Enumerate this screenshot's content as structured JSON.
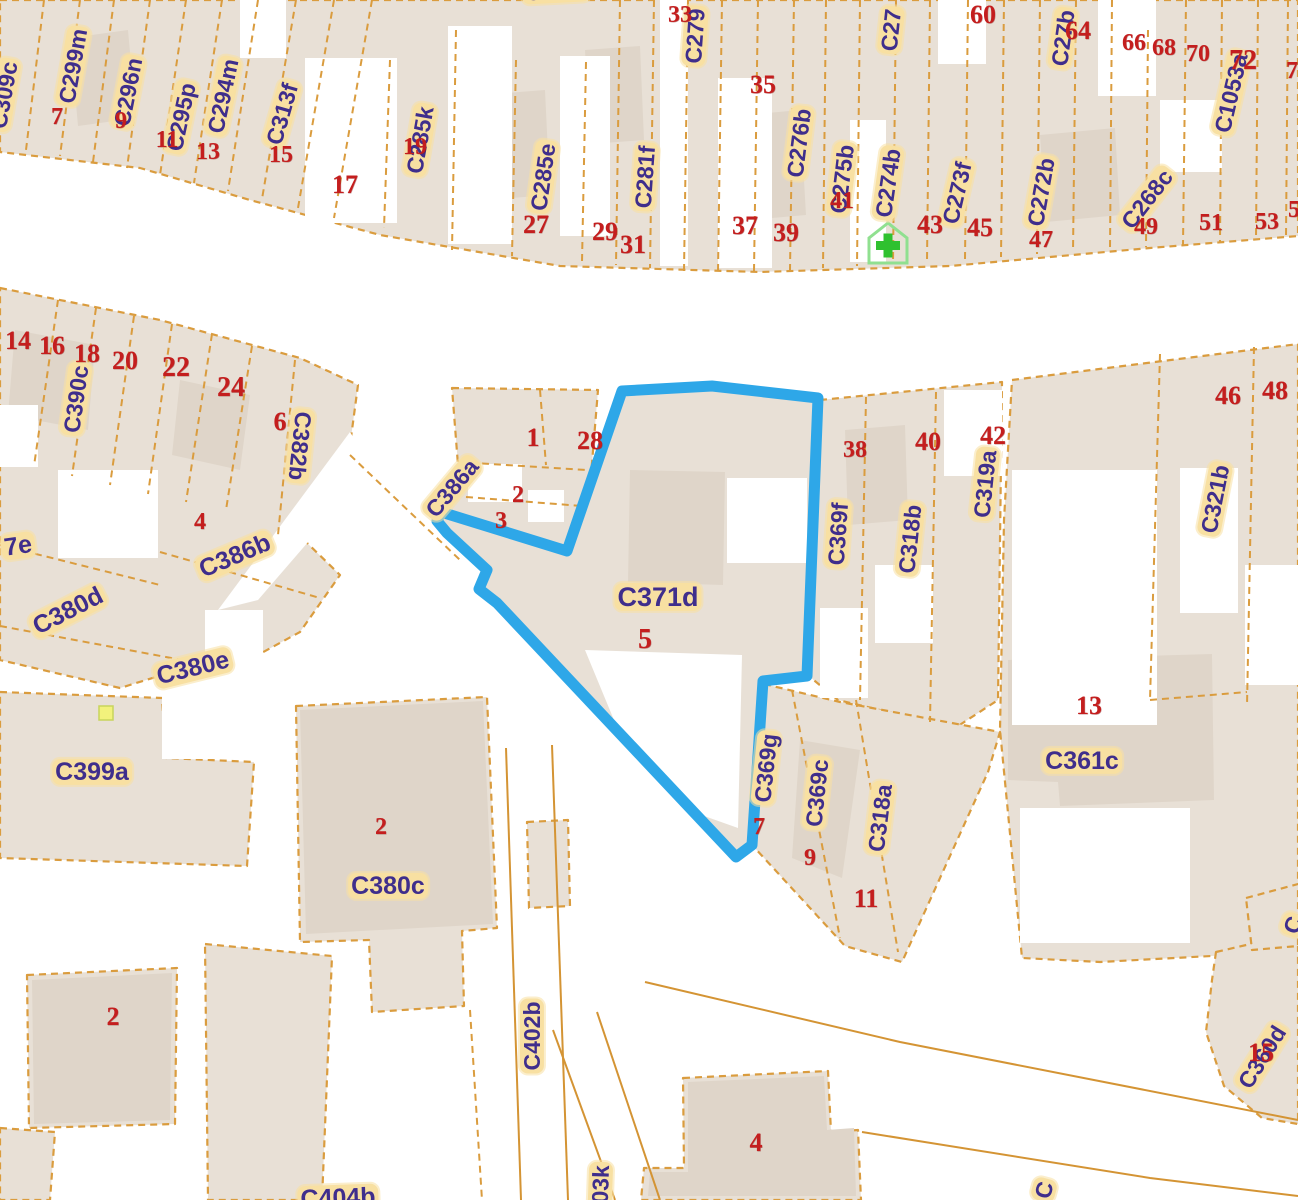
{
  "map": {
    "colors": {
      "parcel_fill": "#E8E0D6",
      "building_fill": "#DFD5C9",
      "road": "#FFFFFF",
      "boundary_orange": "#DA9C3E",
      "label_bg": "#F8E0A2",
      "label_text": "#3F2E8C",
      "house_number_red": "#C41E1E",
      "highlight_blue": "#2EA7E8",
      "pharmacy_green": "#2FC12F",
      "marker_yellow": "#F2F27C"
    },
    "highlight_parcel": {
      "label": "C371d",
      "house_number": "5",
      "outline_points": "622,391 712,386 818,398 807,676 763,681 752,845 736,857 497,603 479,589 487,570 447,533 437,521 441,512 567,551"
    },
    "parcel_labels": [
      {
        "text": "C309c",
        "x": 4,
        "y": 95,
        "rot": -80
      },
      {
        "text": "C299m",
        "x": 73,
        "y": 66,
        "rot": -80
      },
      {
        "text": "C296n",
        "x": 128,
        "y": 92,
        "rot": -79
      },
      {
        "text": "C295p",
        "x": 181,
        "y": 117,
        "rot": -78
      },
      {
        "text": "C294m",
        "x": 223,
        "y": 96,
        "rot": -78
      },
      {
        "text": "C313f",
        "x": 282,
        "y": 114,
        "rot": -74
      },
      {
        "text": "C286f",
        "x": 556,
        "y": -9,
        "rot": -3
      },
      {
        "text": "C285k",
        "x": 420,
        "y": 140,
        "rot": -80
      },
      {
        "text": "C285e",
        "x": 543,
        "y": 177,
        "rot": -82
      },
      {
        "text": "C281f",
        "x": 645,
        "y": 177,
        "rot": -86
      },
      {
        "text": "C279",
        "x": 695,
        "y": 36,
        "rot": -86
      },
      {
        "text": "C276b",
        "x": 799,
        "y": 143,
        "rot": -83
      },
      {
        "text": "C275b",
        "x": 842,
        "y": 179,
        "rot": -83
      },
      {
        "text": "C274b",
        "x": 888,
        "y": 183,
        "rot": -82
      },
      {
        "text": "C273f",
        "x": 957,
        "y": 193,
        "rot": -77
      },
      {
        "text": "C272b",
        "x": 1041,
        "y": 192,
        "rot": -80
      },
      {
        "text": "C268c",
        "x": 1147,
        "y": 199,
        "rot": -52
      },
      {
        "text": "C1053a",
        "x": 1231,
        "y": 93,
        "rot": -77
      },
      {
        "text": "C27",
        "x": 891,
        "y": 30,
        "rot": -84
      },
      {
        "text": "C27b",
        "x": 1063,
        "y": 38,
        "rot": -82
      },
      {
        "text": "C390c",
        "x": 76,
        "y": 399,
        "rot": -82
      },
      {
        "text": "C382b",
        "x": 300,
        "y": 446,
        "rot": 96
      },
      {
        "text": "C386a",
        "x": 452,
        "y": 488,
        "rot": -50
      },
      {
        "text": "C386b",
        "x": 235,
        "y": 556,
        "rot": -23,
        "size": 25
      },
      {
        "text": "C380d",
        "x": 68,
        "y": 611,
        "rot": -27,
        "size": 25
      },
      {
        "text": "C380e",
        "x": 193,
        "y": 668,
        "rot": -14,
        "size": 25
      },
      {
        "text": "7e",
        "x": 18,
        "y": 546,
        "rot": -8,
        "size": 25
      },
      {
        "text": "C399a",
        "x": 92,
        "y": 772,
        "rot": 0,
        "size": 25
      },
      {
        "text": "C371d",
        "x": 658,
        "y": 597,
        "rot": 0,
        "size": 27
      },
      {
        "text": "C369f",
        "x": 838,
        "y": 534,
        "rot": -86
      },
      {
        "text": "C318b",
        "x": 910,
        "y": 539,
        "rot": -84
      },
      {
        "text": "C319a",
        "x": 985,
        "y": 484,
        "rot": -84
      },
      {
        "text": "C321b",
        "x": 1215,
        "y": 499,
        "rot": -79
      },
      {
        "text": "C361c",
        "x": 1082,
        "y": 761,
        "rot": 0,
        "size": 25
      },
      {
        "text": "C369g",
        "x": 766,
        "y": 768,
        "rot": -84
      },
      {
        "text": "C369c",
        "x": 817,
        "y": 793,
        "rot": -84
      },
      {
        "text": "C318a",
        "x": 880,
        "y": 818,
        "rot": -83
      },
      {
        "text": "C380c",
        "x": 388,
        "y": 886,
        "rot": 0,
        "size": 25
      },
      {
        "text": "C402b",
        "x": 532,
        "y": 1036,
        "rot": -90
      },
      {
        "text": "C403k",
        "x": 600,
        "y": 1199,
        "rot": -88
      },
      {
        "text": "C404b",
        "x": 338,
        "y": 1198,
        "rot": -2,
        "size": 25
      },
      {
        "text": "C360d",
        "x": 1262,
        "y": 1057,
        "rot": -58
      },
      {
        "text": "C",
        "x": 1293,
        "y": 925,
        "rot": -70
      },
      {
        "text": "C",
        "x": 1044,
        "y": 1190,
        "rot": -75
      }
    ],
    "house_numbers": [
      {
        "text": "7",
        "x": 57,
        "y": 117,
        "size": 24
      },
      {
        "text": "9",
        "x": 121,
        "y": 121,
        "size": 24
      },
      {
        "text": "11",
        "x": 167,
        "y": 140,
        "size": 24,
        "bold": true
      },
      {
        "text": "13",
        "x": 208,
        "y": 152,
        "size": 24
      },
      {
        "text": "15",
        "x": 281,
        "y": 155,
        "size": 24
      },
      {
        "text": "17",
        "x": 345,
        "y": 185,
        "size": 26
      },
      {
        "text": "19",
        "x": 415,
        "y": 147,
        "size": 24
      },
      {
        "text": "27",
        "x": 536,
        "y": 225,
        "size": 26
      },
      {
        "text": "29",
        "x": 605,
        "y": 232,
        "size": 26
      },
      {
        "text": "31",
        "x": 633,
        "y": 245,
        "size": 26
      },
      {
        "text": "33",
        "x": 680,
        "y": 15,
        "size": 24
      },
      {
        "text": "35",
        "x": 763,
        "y": 85,
        "size": 26
      },
      {
        "text": "37",
        "x": 745,
        "y": 226,
        "size": 26
      },
      {
        "text": "39",
        "x": 786,
        "y": 233,
        "size": 26,
        "bold": true
      },
      {
        "text": "41",
        "x": 842,
        "y": 201,
        "size": 24
      },
      {
        "text": "43",
        "x": 930,
        "y": 225,
        "size": 26
      },
      {
        "text": "45",
        "x": 980,
        "y": 228,
        "size": 26
      },
      {
        "text": "47",
        "x": 1041,
        "y": 240,
        "size": 24
      },
      {
        "text": "49",
        "x": 1146,
        "y": 227,
        "size": 24
      },
      {
        "text": "51",
        "x": 1211,
        "y": 223,
        "size": 24
      },
      {
        "text": "53",
        "x": 1267,
        "y": 222,
        "size": 24
      },
      {
        "text": "5",
        "x": 1294,
        "y": 210,
        "size": 24
      },
      {
        "text": "60",
        "x": 983,
        "y": 15,
        "size": 26,
        "bold": true
      },
      {
        "text": "64",
        "x": 1078,
        "y": 31,
        "size": 26
      },
      {
        "text": "66",
        "x": 1134,
        "y": 43,
        "size": 24
      },
      {
        "text": "68",
        "x": 1164,
        "y": 48,
        "size": 24
      },
      {
        "text": "70",
        "x": 1198,
        "y": 54,
        "size": 24
      },
      {
        "text": "72",
        "x": 1243,
        "y": 61,
        "size": 28,
        "bold": true
      },
      {
        "text": "7",
        "x": 1292,
        "y": 71,
        "size": 24
      },
      {
        "text": "14",
        "x": 18,
        "y": 341,
        "size": 26
      },
      {
        "text": "16",
        "x": 52,
        "y": 346,
        "size": 26
      },
      {
        "text": "18",
        "x": 87,
        "y": 354,
        "size": 26
      },
      {
        "text": "20",
        "x": 125,
        "y": 361,
        "size": 26
      },
      {
        "text": "22",
        "x": 176,
        "y": 368,
        "size": 28,
        "bold": true
      },
      {
        "text": "24",
        "x": 231,
        "y": 388,
        "size": 28,
        "bold": true
      },
      {
        "text": "6",
        "x": 280,
        "y": 422,
        "size": 26,
        "bold": true
      },
      {
        "text": "4",
        "x": 200,
        "y": 522,
        "size": 24
      },
      {
        "text": "1",
        "x": 533,
        "y": 438,
        "size": 26
      },
      {
        "text": "28",
        "x": 590,
        "y": 441,
        "size": 26
      },
      {
        "text": "2",
        "x": 518,
        "y": 495,
        "size": 24
      },
      {
        "text": "3",
        "x": 501,
        "y": 521,
        "size": 24
      },
      {
        "text": "5",
        "x": 645,
        "y": 640,
        "size": 28,
        "bold": true
      },
      {
        "text": "38",
        "x": 855,
        "y": 450,
        "size": 24
      },
      {
        "text": "40",
        "x": 928,
        "y": 442,
        "size": 26
      },
      {
        "text": "42",
        "x": 993,
        "y": 436,
        "size": 26
      },
      {
        "text": "46",
        "x": 1228,
        "y": 396,
        "size": 26
      },
      {
        "text": "48",
        "x": 1275,
        "y": 391,
        "size": 26,
        "bold": true
      },
      {
        "text": "13",
        "x": 1089,
        "y": 706,
        "size": 26
      },
      {
        "text": "7",
        "x": 759,
        "y": 827,
        "size": 24
      },
      {
        "text": "9",
        "x": 810,
        "y": 858,
        "size": 24
      },
      {
        "text": "11",
        "x": 866,
        "y": 899,
        "size": 26,
        "bold": true
      },
      {
        "text": "2",
        "x": 381,
        "y": 827,
        "size": 24,
        "bold": true
      },
      {
        "text": "2",
        "x": 113,
        "y": 1017,
        "size": 26,
        "bold": true
      },
      {
        "text": "4",
        "x": 756,
        "y": 1143,
        "size": 26,
        "bold": true
      },
      {
        "text": "15",
        "x": 1261,
        "y": 1053,
        "size": 26,
        "bold": true
      }
    ],
    "icons": [
      {
        "name": "pharmacy-cross-icon",
        "x": 888,
        "y": 243
      },
      {
        "name": "yellow-square-marker",
        "x": 106,
        "y": 713
      }
    ]
  }
}
